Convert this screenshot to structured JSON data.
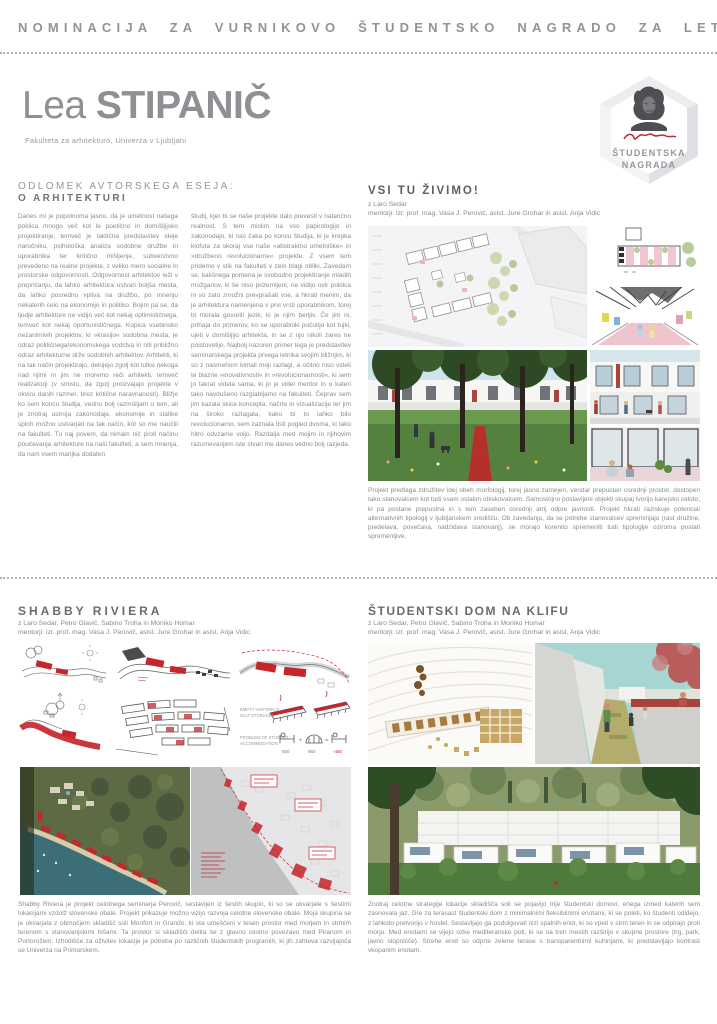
{
  "page": {
    "header": "NOMINACIJA ZA VURNIKOVO ŠTUDENTSKO NAGRADO ZA LETO 2018"
  },
  "author": {
    "first_name": "Lea",
    "last_name": "STIPANIČ",
    "affiliation": "Fakulteta za arhitekturo, Univerza v Ljubljani"
  },
  "badge": {
    "line1": "ŠTUDENTSKA",
    "line2": "NAGRADA",
    "accent_color": "#c1272d"
  },
  "essay": {
    "heading_line1": "ODLOMEK AVTORSKEGA ESEJA:",
    "heading_line2": "O ARHITEKTURI",
    "column1": "Danes mi je popolnoma jasno, da je umetnost našega poklica mnogo več kot le poetično in domišljijsko projektiranje, temveč je taktična predstavitev ideje naročniku, psihološka analiza sodobne družbe in uporabnika ter kritično mišljenje, subverzivno prevedeno na realne projekte, z veliko mero socialne in prostorske odgovornosti. Odgovornost arhitektov leži v prepričanju, da lahko arhitektura ustvari boljša mesta, da lahko posredno vpliva na družbo, po mnenju nekaterih celo na ekonomijo in politiko. Bojim pa se, da ljudje arhitekture ne vidijo več kot nekaj optimističnega, temveč kot nekaj oportunističnega. Kopica vsebinsko nezanimivih projektov, ki »krasijo« sodobna mesta, je odraz političnega/ekonomskega vodstva in niti približno odraz arhitekturne drže sodobnih arhitektov. Arhitekti, ki na tak način projektirajo, delujejo zgolj kot lutke nekoga nad njimi in jim ne moremo reči arhitekti, temveč realizatorji (v smislu, da zgolj proizvajajo projekte v okviru danih razmer, brez kritične naravnanosti). Bližje ko sem koncu študija, vedno bolj razmišljam o tem, ali je znotraj ustroja zakonodaje, ekonomije in statike sploh možno ustvarjati na tak način, kot so me naučili na fakulteti. Tu naj povem, da nimam nič proti načinu poučevanja arhitekture na naši fakulteti, a sem mnenja, da nam vsem manjka dodaten",
    "column2": "študij, kjer bi se naše projekte dalo prevesti v natančno realnost. S tem mislim na vso papirologijo in zakonodajo, ki nas čaka po koncu študija, ki je krepka klofuta za skoraj vse naše »abstraktno umetniške« in »družbeno revolucionarne« projekte. Z vsem tem pridemo v stik na fakulteti v zelo blagi obliki. Zavedam se, kakšnega pomena je svobodno projektiranje mladih možganov, ki še niso prizemljeni, ne vidijo ovir poklica in so zato zmožni prevprašati vse, a hkrati menim, da je arhitektura namenjena v prvi vrsti uporabnikom, torej bi morala govoriti jezik, ki je njim berljiv. Če jim ni, prihaja do primerov, ko se uporabniki počutijo kot tujki, ujeti v domišljijo arhitekta, in se z njo nikoli zares ne poistovetijo. Najbolj nazoren primer tega je predstavitev seminarskega projekta prvega letnika svojim bližnjim, ki so z nasmehom kimali moji razlagi, a očitno niso videli te blazne »inovativnosti« in »revolucionarnosti«, ki sem jo takrat videla sama, ki jo je videl mentor in o kateri tako navdušeno razglabljamo na fakulteti. Čeprav sem jim kazala skice koncepta, načrte in vizualizacije ter jim na široko razlagala, kako bi to lahko bilo revolucionarno, sem zaznala tisti pogled dvoma, ki tako hitro odvzame voljo. Razdalja med mojim in njihovim razumevanjem iste stvari me danes vedno bolj razjeda."
  },
  "projects": {
    "vsi": {
      "title": "VSI TU ŽIVIMO!",
      "team": "z Laro Sedar",
      "mentors": "mentorji: izr. prof. mag. Vasa J. Perovič, asist. Jure Grohar in asist. Anja Vidic",
      "caption": "Projekt predlaga združitev idej obeh morfologij, torej jasno zamejen, vendar prepusten osrednji prostor, dostopen tako stanovalcem kot tudi vsem ostalim obiskovalcem. Samostojno postavljeni objekti skupaj tvorijo karejsko celoto, ki pa postane prepustna in s tem zaseben osrednji atrij odpre javnosti. Projekt hkrati raziskuje potencial alternativnih tipologij v ljubljanskem središču. Ob zavedanju, da se potrebe stanovalcev spreminjajo (rast družine, predelava, povečava, nadzidava stanovanj), se morajo korenito spremeniti tudi tipologije oziroma postati spremenljive."
    },
    "shabby": {
      "title": "SHABBY RIVIERA",
      "team": "z Laro Sedar, Petro Glavič, Sabino Troha in Moniko Homar",
      "mentors": "mentorji: izr. prof. mag. Vasa J. Perovič, asist. Jure Grohar in asist. Anja Vidic",
      "caption": "Shabby Riviera je projekt celotnega seminarja Perovič, sestavljen iz šestih skupin, ki so se ukvarjale s šestimi lokacijami vzdolž slovenske obale. Projekt prikazuje možno vizijo razvoja celotne slovenske obale. Moja skupina se je ukvarjala z območjem skladišč soli Monfort in Grando, ki sta umeščeni v tesen prostor med morjem in strmim terenom s stanovanjskimi hišami. Ta prostor si skladišči delita še z glavno cestno povezavo med Piranom in Portorožem. Izhodišče za oživitev lokacije je potreba po različnih študentskih programih, ki jih zahteva razvijajoča se Univerza na Primorskem.",
      "labels": {
        "l1a": "EMPTY HISTORICAL",
        "l1b": "SALT STORAGES",
        "l2a": "PROBLEM OF STUDENT",
        "l2b": "ACCOMMODATION",
        "v1": "500",
        "v2": "950",
        "v3": "-450"
      }
    },
    "klif": {
      "title": "ŠTUDENTSKI DOM NA KLIFU",
      "team": "z Laro Sedar, Petro Glavič, Sabino Troha in Moniko Homar",
      "mentors": "mentorji: izr. prof. mag. Vasa J. Perovič, asist. Jure Grohar in asist. Anja Vidic",
      "caption": "Znotraj celotne strategije lokacije skladišča soli se pojavijo trije študentski domovi, enega izmed katerih sem zasnovala jaz. Gre za terasast študentski dom z minimalnimi fleksibilnimi enotami, ki se poleti, ko študenti odidejo, z lahkoto pretvorijo v hostel. Sestavljajo ga podolgovati nizi spalnih enot, ki so vpeti v strm teren in se odpirajo proti morju. Med enotami se vijejo ozke mediteranske poti, ki se na treh mestih razširijo v skupne prostore (trg, park, javno stopnišče). Strehe enot so odprte zelene terase s transparentnimi kuhinjami, ki predstavljajo kontrast vkopanim enotam."
    }
  },
  "colors": {
    "accent_red": "#c5262c",
    "text_gray": "#8a8b8f",
    "heading_gray": "#5d5e61",
    "header_gray": "#919396"
  }
}
